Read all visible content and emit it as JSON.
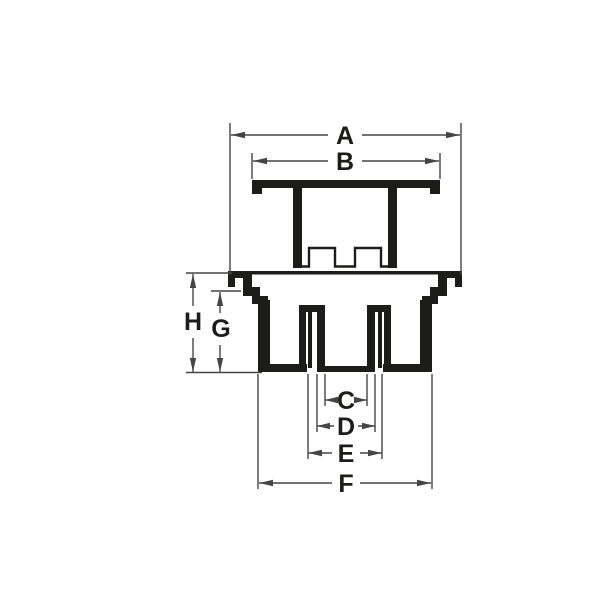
{
  "page": {
    "background": "#ffffff"
  },
  "drawing": {
    "kind": "technical-cross-section",
    "description": "Black-and-white sectional line drawing of a two-piece fitting (cap with castellated skirt above, flanged body with inner tube below) annotated with dimension arrows",
    "colors": {
      "part_outline": "#1c1c1a",
      "dimension_line": "#454545",
      "label_text": "#1c1c1a",
      "background": "#ffffff"
    },
    "dimensions": {
      "a": {
        "label": "A",
        "axis": "horizontal",
        "position": "top-outer"
      },
      "b": {
        "label": "B",
        "axis": "horizontal",
        "position": "top-inner"
      },
      "c": {
        "label": "C",
        "axis": "horizontal",
        "position": "bottom-1"
      },
      "d": {
        "label": "D",
        "axis": "horizontal",
        "position": "bottom-2"
      },
      "e": {
        "label": "E",
        "axis": "horizontal",
        "position": "bottom-3"
      },
      "f": {
        "label": "F",
        "axis": "horizontal",
        "position": "bottom-4"
      },
      "g": {
        "label": "G",
        "axis": "vertical",
        "position": "left-inner"
      },
      "h": {
        "label": "H",
        "axis": "vertical",
        "position": "left-outer"
      }
    }
  }
}
